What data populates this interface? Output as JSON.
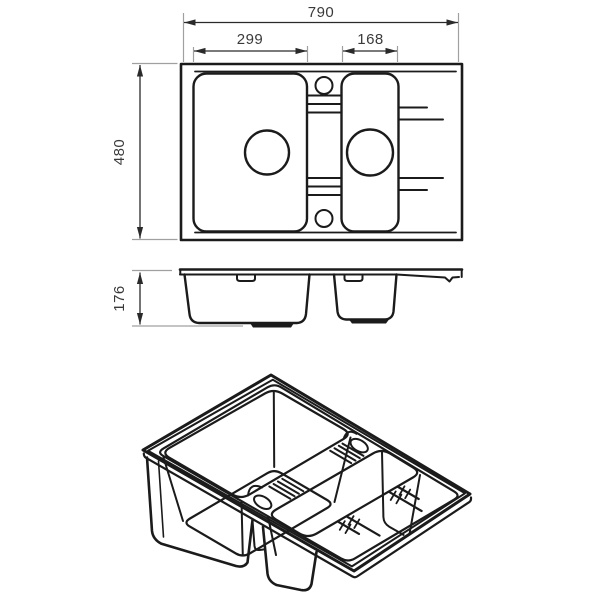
{
  "drawing": {
    "dimensions": {
      "overall_length_mm": "790",
      "left_bowl_length_mm": "299",
      "right_bowl_length_mm": "168",
      "overall_width_mm": "480",
      "depth_mm": "176"
    },
    "colors": {
      "line": "#1b1b1b",
      "extension_line": "#a0a0a0",
      "dimension_text": "#3a3a3a",
      "background": "#ffffff"
    }
  }
}
